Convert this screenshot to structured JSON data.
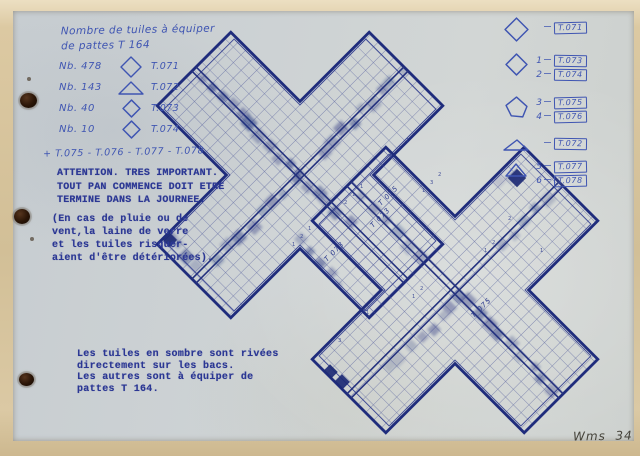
{
  "page": {
    "ref": "Wms  34"
  },
  "colors": {
    "paper": "#cdd2d3",
    "scan_border": "#d6c5a0",
    "ink_blue": "#3f55b2",
    "typed_blue": "#2b3794",
    "drawing_blue": "#27348b",
    "smudge_blue": "#24337f"
  },
  "handwritten_note": {
    "line1": "Nombre de tuiles à équiper",
    "line2": "de pattes T 164",
    "items": [
      {
        "qty": "Nb. 478",
        "shape": "diamond",
        "ref": "T.071"
      },
      {
        "qty": "Nb. 143",
        "shape": "triangle",
        "ref": "T.072"
      },
      {
        "qty": "Nb. 40",
        "shape": "diamond",
        "ref": "T.073"
      },
      {
        "qty": "Nb. 10",
        "shape": "diamond",
        "ref": "T.074"
      }
    ],
    "extra": "+ T.075 - T.076 - T.077 - T.078"
  },
  "warning": {
    "lines": [
      "ATTENTION. TRES IMPORTANT.",
      "TOUT PAN COMMENCE DOIT ETRE",
      "TERMINE DANS LA JOURNEE."
    ],
    "parenthetical": [
      "(En cas de pluie ou de",
      "vent,la laine de verre",
      "et les tuiles risquer-",
      "aient d'être détériorées)."
    ]
  },
  "footer_note": {
    "lines": [
      "Les tuiles en sombre sont rivées",
      "directement sur les bacs.",
      "Les autres sont à équiper de",
      "pattes T 164."
    ]
  },
  "legend": {
    "rows": [
      {
        "shape": "diamond-large",
        "entries": [
          {
            "num": "",
            "ref": "T.071"
          }
        ]
      },
      {
        "shape": "diamond",
        "entries": [
          {
            "num": "1",
            "ref": "T.073"
          },
          {
            "num": "2",
            "ref": "T.074"
          }
        ]
      },
      {
        "shape": "pentagon",
        "entries": [
          {
            "num": "3",
            "ref": "T.075"
          },
          {
            "num": "4",
            "ref": "T.076"
          }
        ]
      },
      {
        "shape": "triangle-wide",
        "entries": [
          {
            "num": "",
            "ref": "T.072"
          }
        ]
      },
      {
        "shape": "triangle",
        "entries": [
          {
            "num": "5",
            "ref": "T.077"
          },
          {
            "num": "6",
            "ref": "T.078"
          }
        ]
      }
    ]
  },
  "diagram": {
    "band_labels": [
      {
        "text": "T 075",
        "x": 381,
        "y": 206
      },
      {
        "text": "T 073",
        "x": 373,
        "y": 228
      },
      {
        "text": "T 073",
        "x": 327,
        "y": 262
      },
      {
        "text": "T 075",
        "x": 474,
        "y": 318
      }
    ],
    "cell_digits": [
      {
        "x": 352,
        "y": 196,
        "t": "1"
      },
      {
        "x": 344,
        "y": 204,
        "t": "2"
      },
      {
        "x": 360,
        "y": 188,
        "t": "1"
      },
      {
        "x": 398,
        "y": 150,
        "t": "2"
      },
      {
        "x": 406,
        "y": 142,
        "t": "1"
      },
      {
        "x": 390,
        "y": 158,
        "t": "1"
      },
      {
        "x": 300,
        "y": 238,
        "t": "2"
      },
      {
        "x": 292,
        "y": 246,
        "t": "1"
      },
      {
        "x": 308,
        "y": 230,
        "t": "1"
      },
      {
        "x": 430,
        "y": 184,
        "t": "3"
      },
      {
        "x": 438,
        "y": 176,
        "t": "2"
      },
      {
        "x": 422,
        "y": 192,
        "t": "1"
      },
      {
        "x": 484,
        "y": 252,
        "t": "1"
      },
      {
        "x": 492,
        "y": 244,
        "t": "2"
      },
      {
        "x": 412,
        "y": 298,
        "t": "1"
      },
      {
        "x": 420,
        "y": 290,
        "t": "2"
      },
      {
        "x": 366,
        "y": 314,
        "t": "1"
      },
      {
        "x": 338,
        "y": 342,
        "t": "3"
      },
      {
        "x": 508,
        "y": 220,
        "t": "2"
      },
      {
        "x": 540,
        "y": 252,
        "t": "1"
      }
    ]
  }
}
